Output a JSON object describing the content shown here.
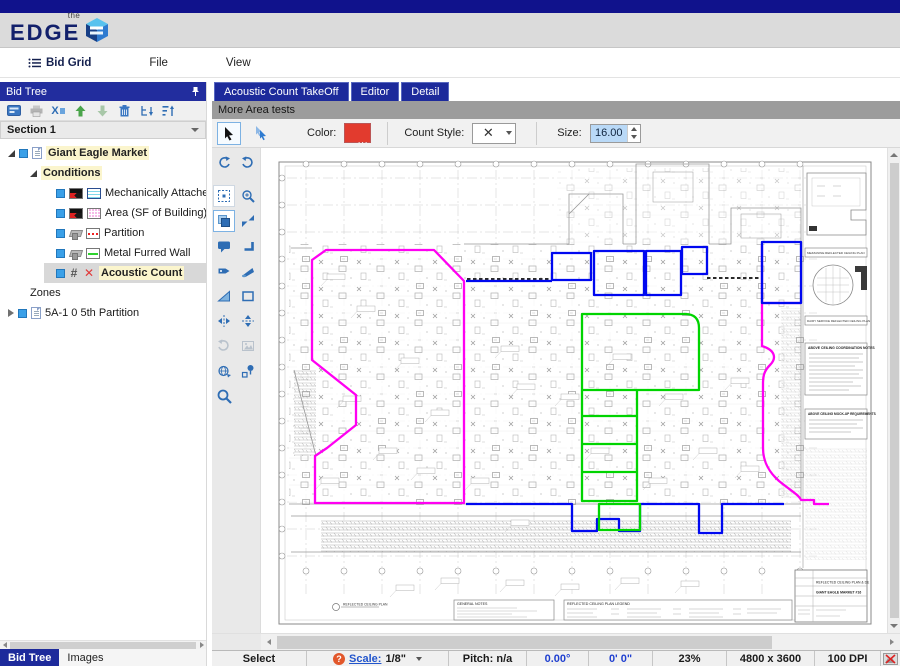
{
  "logo": {
    "the": "the",
    "edge": "EDGE"
  },
  "menu": {
    "items": [
      {
        "label": "Bid Grid"
      },
      {
        "label": "File"
      },
      {
        "label": "View"
      }
    ]
  },
  "left_panel": {
    "header": "Bid Tree",
    "section_selector": "Section 1",
    "tree": {
      "root": "Giant Eagle Market",
      "group": "Conditions",
      "items": [
        {
          "label": "Mechanically Attached TPO("
        },
        {
          "label": "Area (SF of Building)"
        },
        {
          "label": "Partition"
        },
        {
          "label": "Metal Furred Wall"
        },
        {
          "label": "Acoustic Count"
        }
      ],
      "zones": "Zones",
      "zone_item": "5A-1 0 5th Partition",
      "hash_glyph": "#",
      "x_glyph": "✕"
    },
    "toolbar_x3": "X",
    "tabs": [
      {
        "label": "Bid Tree"
      },
      {
        "label": "Images"
      }
    ]
  },
  "editor": {
    "tabs": [
      {
        "label": "Acoustic Count TakeOff"
      },
      {
        "label": "Editor"
      },
      {
        "label": "Detail"
      }
    ],
    "section_bar": "More Area tests",
    "toolbar": {
      "color_label": "Color:",
      "color_value": "#e23b2e",
      "color_dots": "...",
      "count_style_label": "Count Style:",
      "count_style_glyph": "✕",
      "size_label": "Size:",
      "size_value": "16.00"
    }
  },
  "status_bar": {
    "mode": "Select",
    "help_glyph": "?",
    "scale_label": "Scale:",
    "scale_value": "1/8\"",
    "pitch": "Pitch: n/a",
    "angle": "0.00°",
    "length": "0' 0\"",
    "zoom": "23%",
    "image_size": "4800 x 3600",
    "dpi": "100 DPI"
  },
  "canvas": {
    "overlay_colors": {
      "magenta": "#ff00f2",
      "green": "#00d400",
      "blue": "#0008f0"
    },
    "sheet": {
      "plan_caption": "REFLECTED CEILING PLAN",
      "general_notes_title": "GENERAL NOTES",
      "legend_title": "REFLECTED CEILING PLAN LEGEND",
      "coordination_title": "ABOVE CEILING COORDINATION NOTES",
      "mockup_title": "ABOVE CEILING MOCK-UP REQUIREMENTS",
      "detail1_caption": "MEZZANINE REFLECTED CEILING PLAN",
      "detail2_caption": "DAIRY SERVICE REFLECTED CEILING PLAN",
      "titleblock_project": "REFLECTED CEILING PLAN & DE",
      "titleblock_name": "GIANT EAGLE MARKET #16"
    }
  }
}
